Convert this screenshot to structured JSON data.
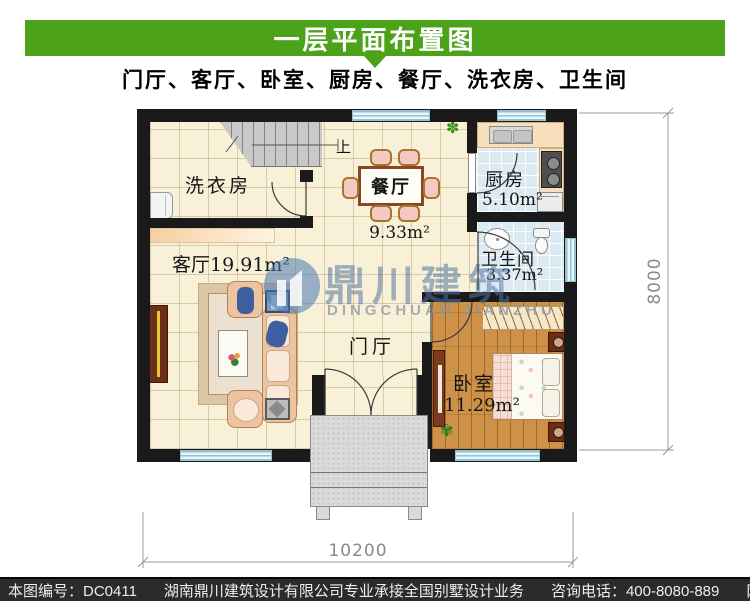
{
  "header": {
    "title": "一层平面布置图",
    "subtitle": "门厅、客厅、卧室、厨房、餐厅、洗衣房、卫生间"
  },
  "plan": {
    "rooms": {
      "laundry": {
        "label": "洗衣房"
      },
      "dining": {
        "label": "餐厅",
        "area": "9.33m²"
      },
      "kitchen": {
        "label": "厨房",
        "area": "5.10m²"
      },
      "bath": {
        "label": "卫生间",
        "area": "3.37m²"
      },
      "living": {
        "label": "客厅",
        "area": "19.91m²"
      },
      "foyer": {
        "label": "门厅"
      },
      "bedroom": {
        "label": "卧室",
        "area": "11.29m²"
      }
    },
    "stairs_label": "上",
    "dim_height": "8000",
    "dim_width": "10200"
  },
  "watermark": {
    "cn": "鼎川建筑",
    "en": "DINGCHUAN JIANZHU"
  },
  "footer": {
    "plan_no": "本图编号：DC0411",
    "company": "湖南鼎川建筑设计有限公司专业承接全国别墅设计业务",
    "phone": "咨询电话：400-8080-889",
    "website": "网址：www.bstzcs.com"
  },
  "colors": {
    "header_green": "#4ca319",
    "wall": "#1a1a1a",
    "window_blue": "#cfe9f3",
    "wood_floor": "#cd9148"
  }
}
